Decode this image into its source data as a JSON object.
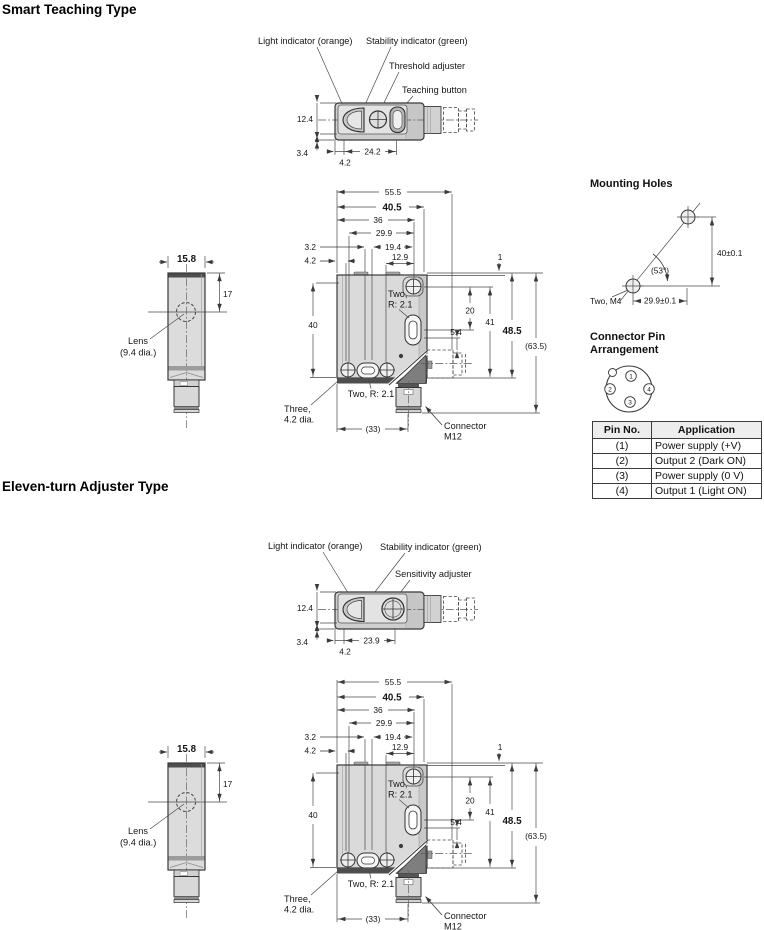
{
  "headings": {
    "smart": "Smart Teaching Type",
    "eleven": "Eleven-turn Adjuster Type",
    "mounting": "Mounting Holes",
    "pin1": "Connector Pin",
    "pin2": "Arrangement"
  },
  "top_smart": {
    "light": "Light indicator (orange)",
    "stability": "Stability indicator (green)",
    "adjuster": "Threshold adjuster",
    "button": "Teaching button",
    "d_h": "12.4",
    "d_b": "3.4",
    "d_o": "4.2",
    "d_w": "24.2"
  },
  "top_eleven": {
    "light": "Light indicator (orange)",
    "stability": "Stability indicator (green)",
    "adjuster": "Sensitivity adjuster",
    "d_h": "12.4",
    "d_b": "3.4",
    "d_o": "4.2",
    "d_w": "23.9"
  },
  "side_view": {
    "d_w": "15.8",
    "d_17": "17",
    "lens1": "Lens",
    "lens2": "(9.4 dia.)"
  },
  "front_view": {
    "d555": "55.5",
    "d405": "40.5",
    "d36": "36",
    "d299": "29.9",
    "d32": "3.2",
    "d42": "4.2",
    "d194": "19.4",
    "d129": "12.9",
    "d1": "1",
    "two_r_a1": "Two,",
    "two_r_a2": "R: 2.1",
    "d20": "20",
    "d54": "5.4",
    "d40": "40",
    "d41": "41",
    "d485": "48.5",
    "d635": "(63.5)",
    "three1": "Three,",
    "three2": "4.2 dia.",
    "two_r_b": "Two, R: 2.1",
    "d33": "(33)",
    "conn1": "Connector",
    "conn2": "M12"
  },
  "mounting": {
    "dv": "40±0.1",
    "dh": "29.9±0.1",
    "angle": "(53°)",
    "label": "Two, M4"
  },
  "pins": {
    "p1": "1",
    "p2": "2",
    "p3": "3",
    "p4": "4"
  },
  "pin_table": {
    "h1": "Pin No.",
    "h2": "Application",
    "rows": [
      {
        "no": "(1)",
        "app": "Power supply (+V)"
      },
      {
        "no": "(2)",
        "app": "Output 2 (Dark ON)"
      },
      {
        "no": "(3)",
        "app": "Power supply (0 V)"
      },
      {
        "no": "(4)",
        "app": "Output 1 (Light ON)"
      }
    ]
  }
}
